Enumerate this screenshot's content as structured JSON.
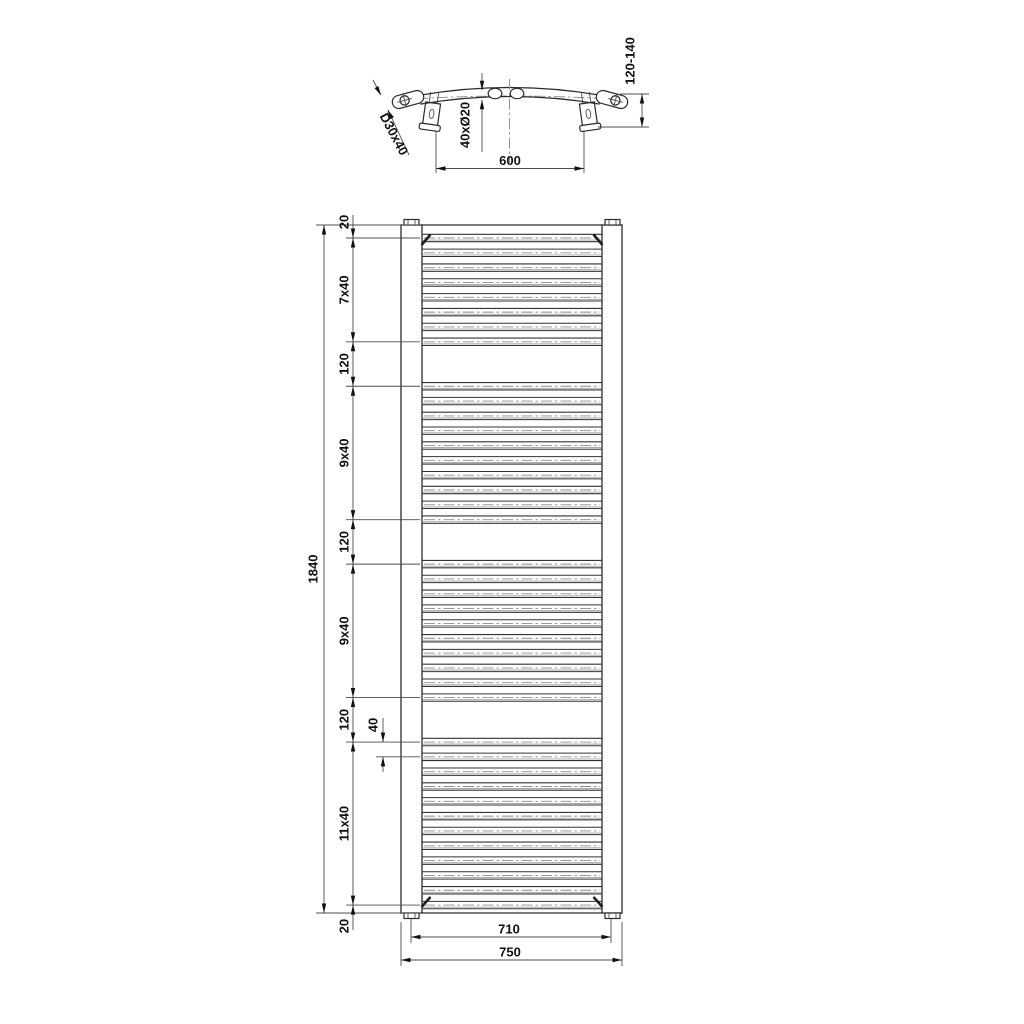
{
  "drawing": {
    "kind": "technical dimension drawing",
    "subject": "curved ladder towel radiator, top view and front view",
    "units": "mm"
  },
  "top_view": {
    "wall_distance": "120-140",
    "rail_profile": "D30x40",
    "tube_spec": "40xØ20",
    "bracket_spacing": "600"
  },
  "front_view": {
    "overall_height": "1840",
    "segment_labels": [
      "20",
      "7x40",
      "120",
      "9x40",
      "120",
      "9x40",
      "120",
      "11x40",
      "20"
    ],
    "pitch_detail": "40",
    "rail_spacing": "710",
    "overall_width": "750",
    "tube_groups": [
      8,
      10,
      10,
      12
    ],
    "tube_count": 40,
    "tube_pitch_mm": 40,
    "group_gap_mm": 120
  }
}
